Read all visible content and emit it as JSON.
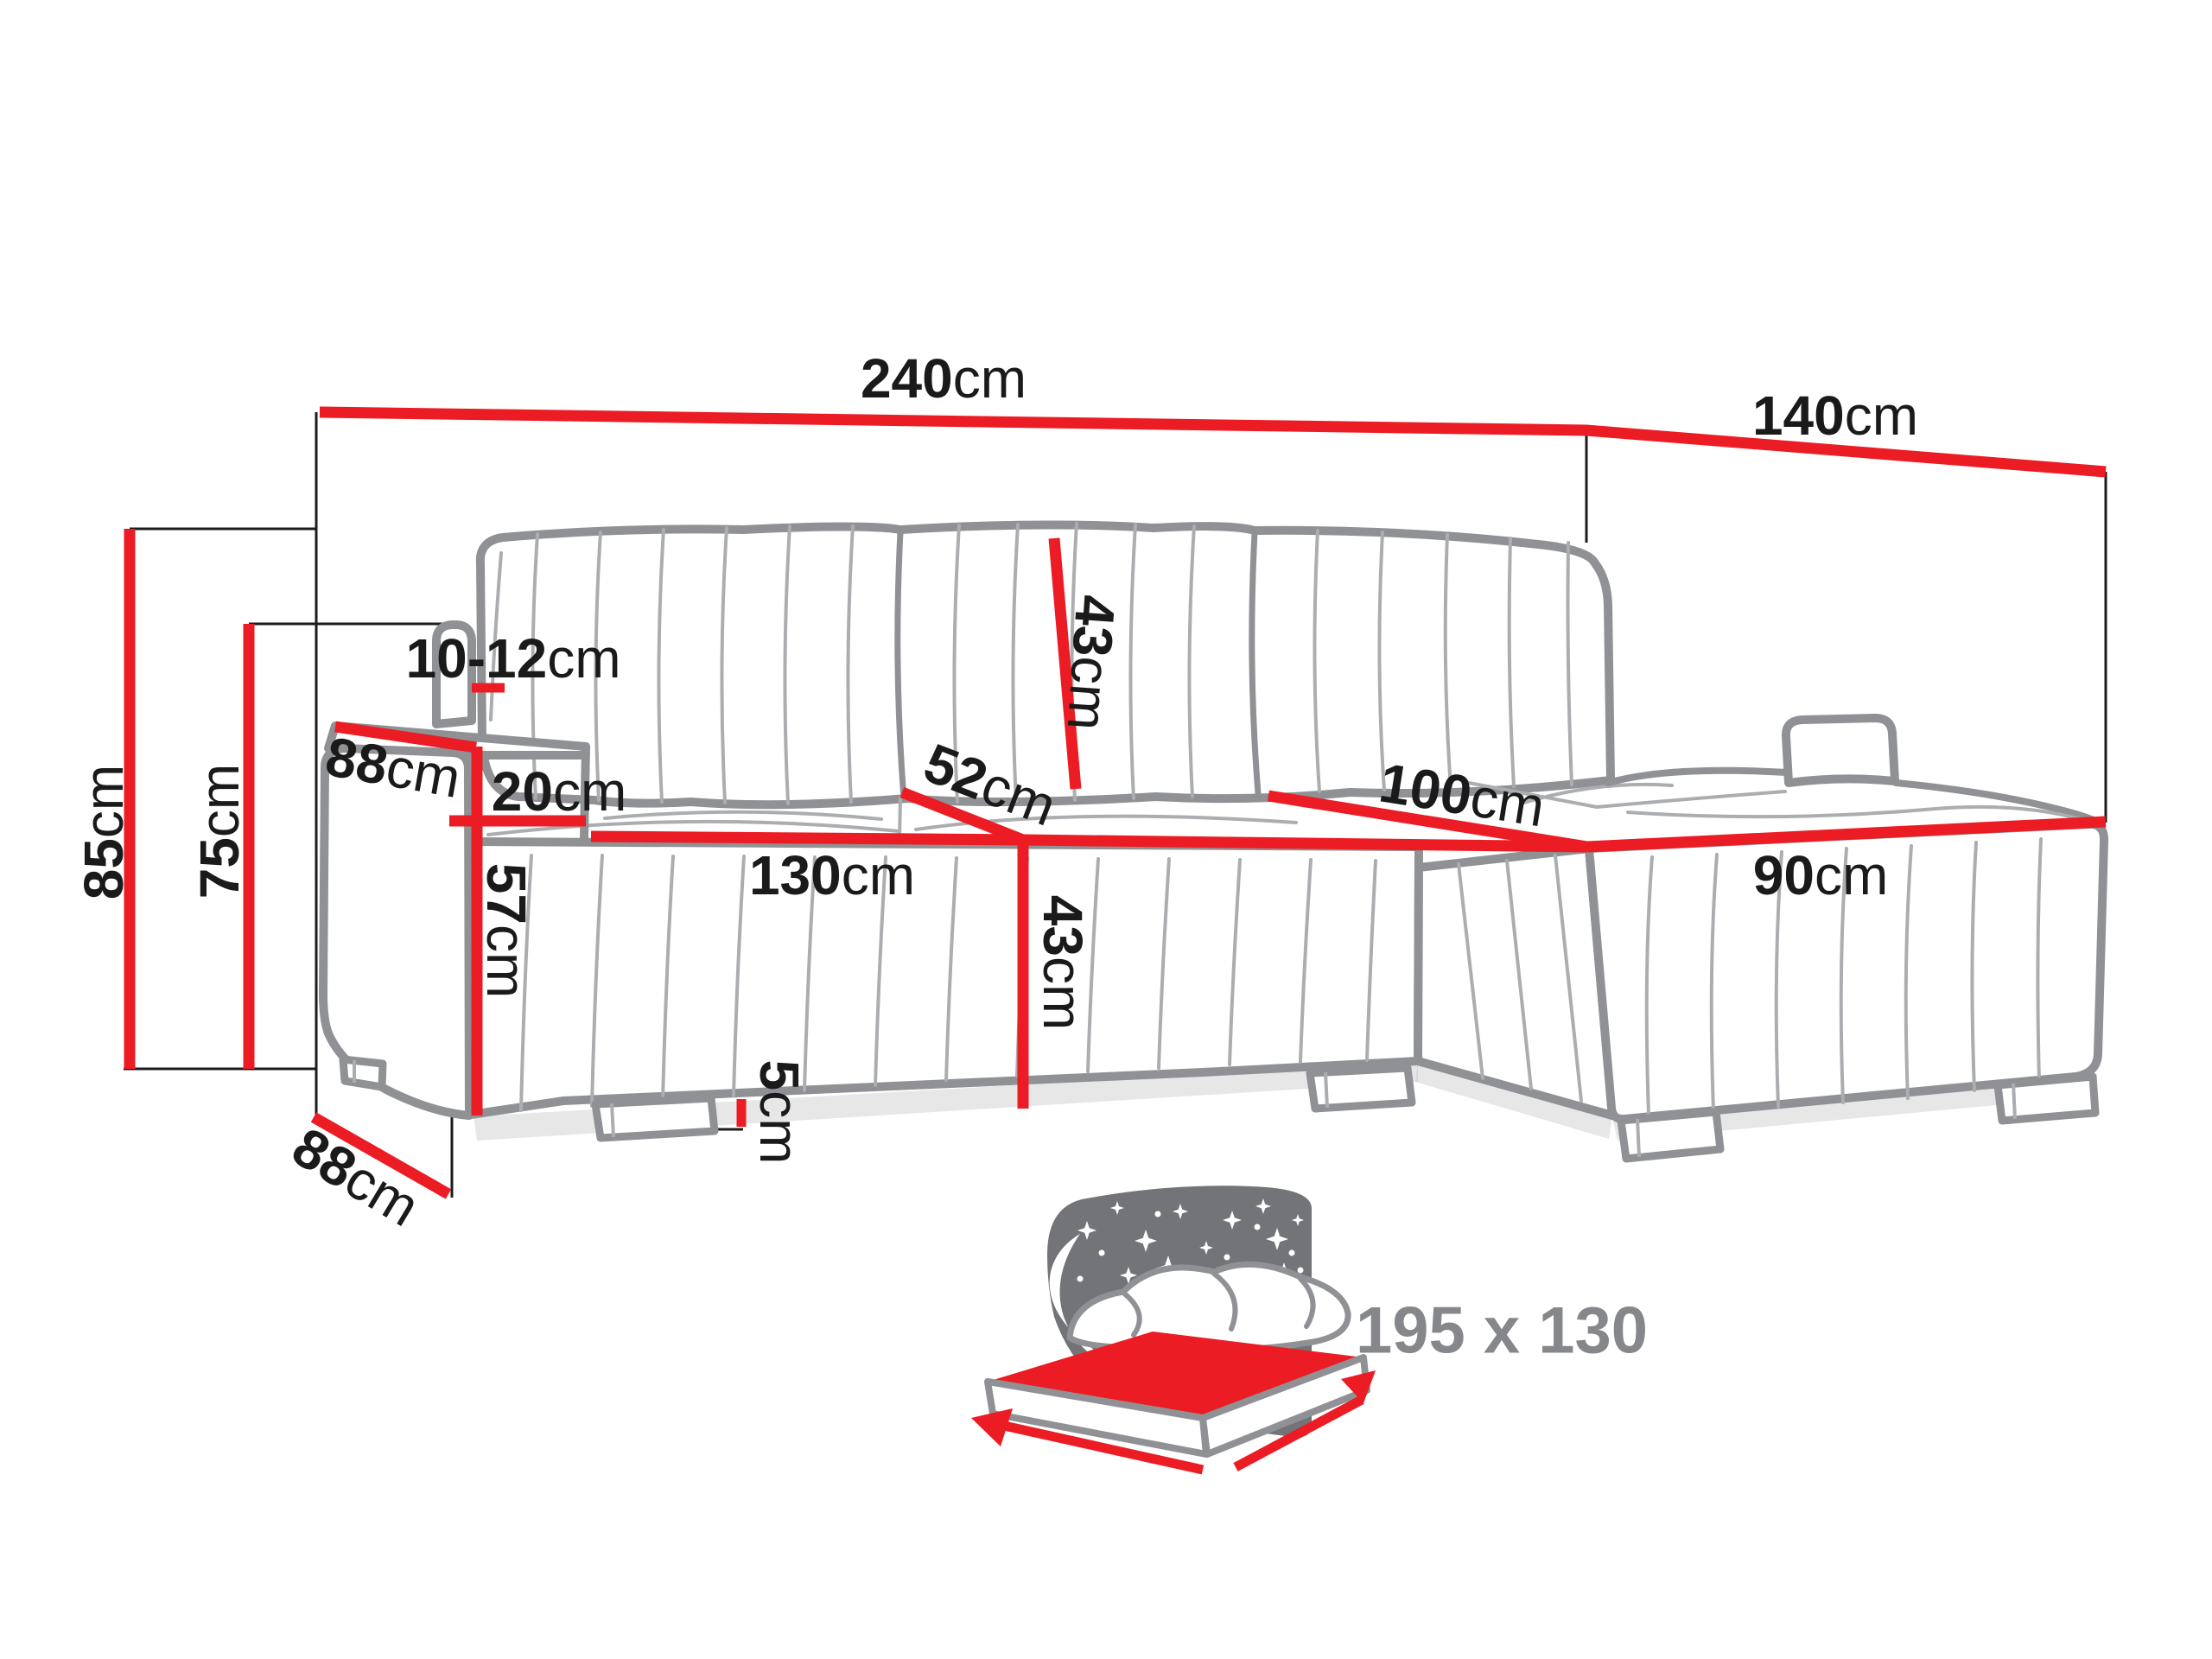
{
  "diagram": {
    "dimensions": {
      "total_width": {
        "value": "240",
        "unit": "cm"
      },
      "total_depth": {
        "value": "140",
        "unit": "cm"
      },
      "total_height": {
        "value": "85",
        "unit": "cm"
      },
      "armrest_height": {
        "value": "75",
        "unit": "cm"
      },
      "backrest_gap": {
        "value": "10-12",
        "unit": "cm"
      },
      "armrest_depth": {
        "value": "88",
        "unit": "cm"
      },
      "armrest_width": {
        "value": "20",
        "unit": "cm"
      },
      "base_front_height": {
        "value": "57",
        "unit": "cm"
      },
      "seat_width": {
        "value": "130",
        "unit": "cm"
      },
      "seat_height": {
        "value": "43",
        "unit": "cm"
      },
      "seat_depth": {
        "value": "52",
        "unit": "cm"
      },
      "backrest_height": {
        "value": "43",
        "unit": "cm"
      },
      "chaise_depth": {
        "value": "100",
        "unit": "cm"
      },
      "chaise_width": {
        "value": "90",
        "unit": "cm"
      },
      "base_depth": {
        "value": "88",
        "unit": "cm"
      },
      "leg_height": {
        "value": "5",
        "unit": "cm"
      }
    },
    "sleeping_area": {
      "label": "195 x 130"
    },
    "colors": {
      "dimension_red": "#EC1C24",
      "outline_gray": "#8F9194",
      "detail_gray": "#ABADB0",
      "panel_gray": "#727477",
      "label_gray": "#85878A",
      "text_black": "#1A1A1A"
    }
  }
}
